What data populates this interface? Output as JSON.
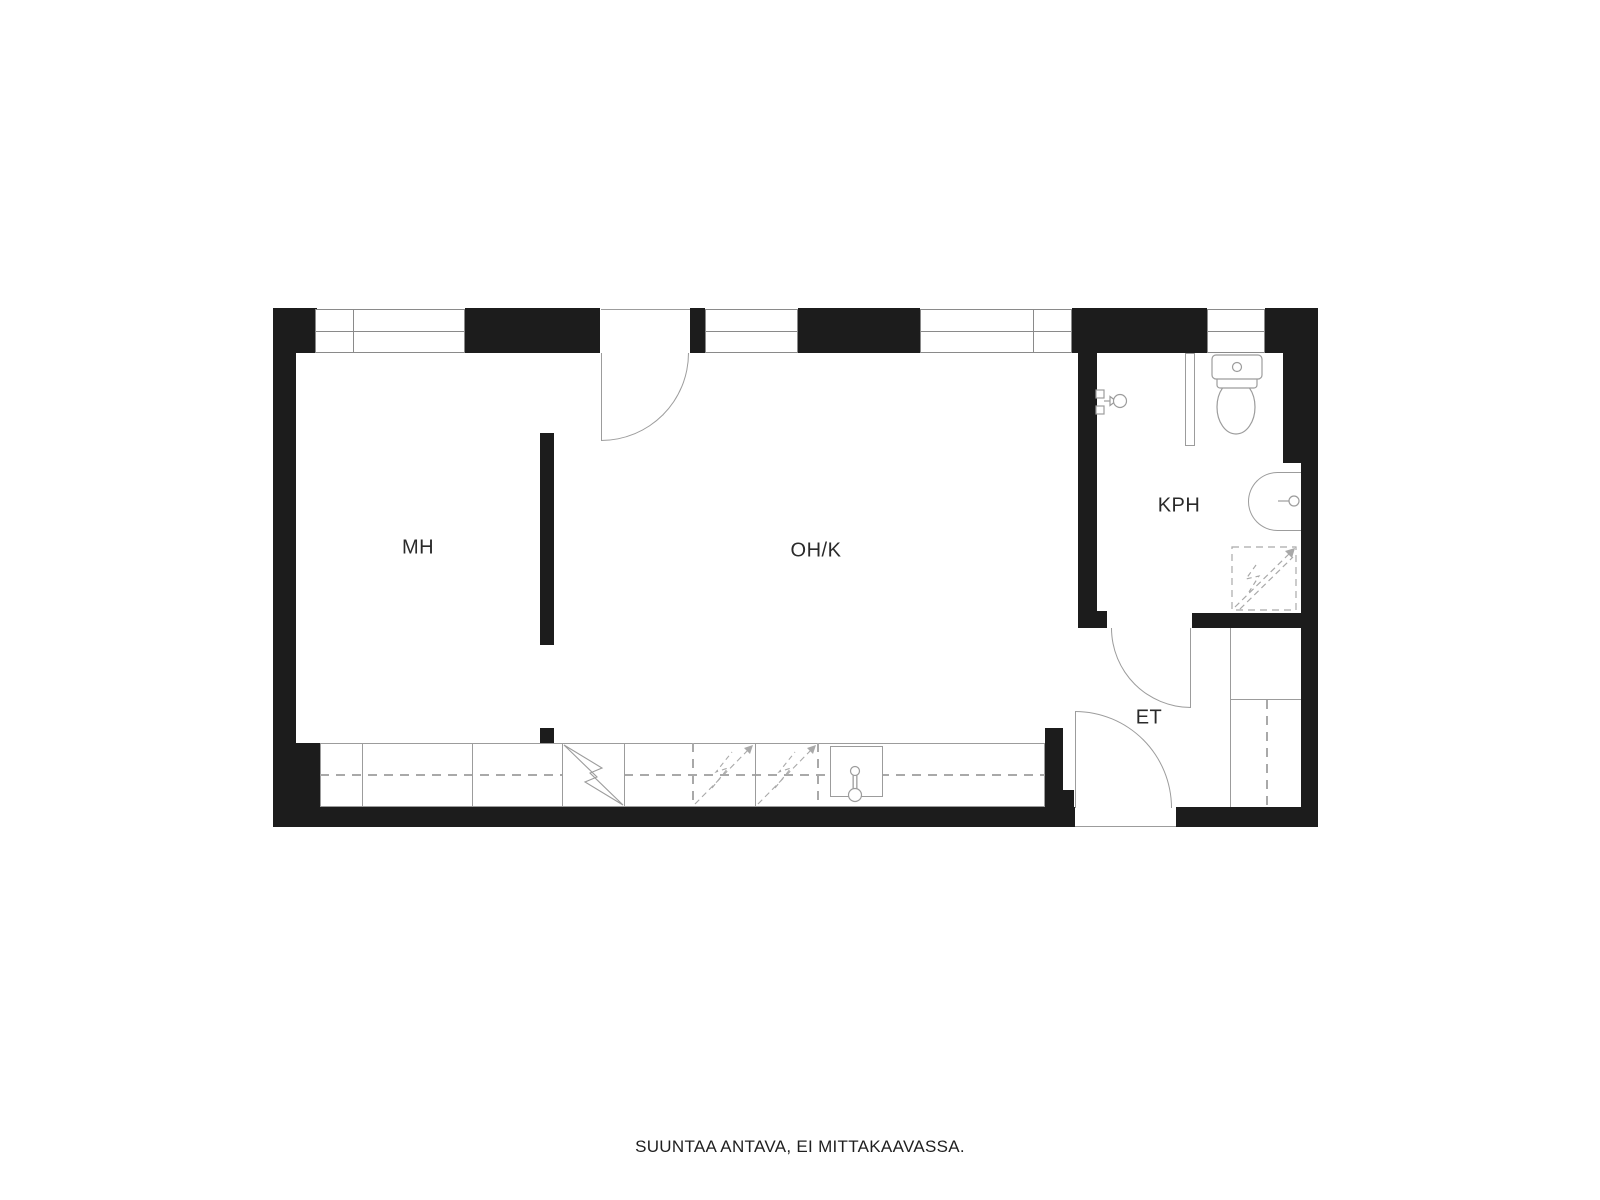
{
  "floorplan": {
    "rooms": [
      {
        "id": "mh",
        "label": "MH"
      },
      {
        "id": "ohk",
        "label": "OH/K"
      },
      {
        "id": "kph",
        "label": "KPH"
      },
      {
        "id": "et",
        "label": "ET"
      }
    ],
    "caption": "SUUNTAA ANTAVA, EI MITTAKAAVASSA.",
    "colors": {
      "wall": "#1c1c1c",
      "line": "#9c9c9c",
      "line_dark": "#8a8a8a",
      "label": "#2a2a2a",
      "background": "#ffffff"
    },
    "icons": [
      "toilet-icon",
      "washbasin-icon",
      "shower-mixer-icon",
      "shower-area-symbol",
      "kitchen-sink-icon",
      "refrigerator-symbol",
      "appliance-reservation-symbol",
      "door-arc",
      "window",
      "wardrobe"
    ]
  }
}
